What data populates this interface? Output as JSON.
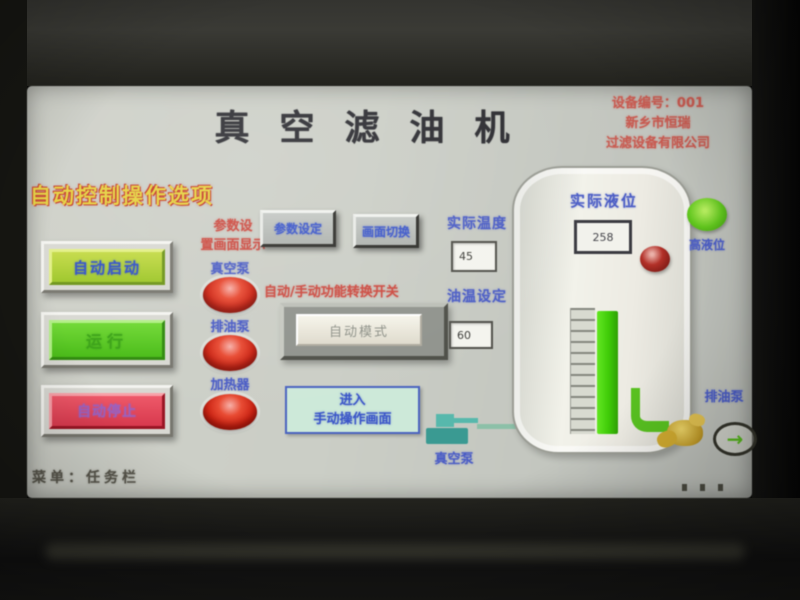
{
  "screen": {
    "title": "真空滤油机",
    "vendor": {
      "line1": "设备编号：001",
      "line2": "新乡市恒瑞",
      "line3": "过滤设备有限公司"
    },
    "left_panel": {
      "heading": "自动控制操作选项",
      "buttons": [
        {
          "label": "自动启动",
          "color": "#a8cc30"
        },
        {
          "label": "运行",
          "color": "#55c41e"
        },
        {
          "label": "自动停止",
          "color": "#e04456"
        }
      ]
    },
    "lamp_column": {
      "note_line1": "参数设",
      "note_line2": "置画面显示",
      "items": [
        {
          "label": "真空泵",
          "color": "#cc2212"
        },
        {
          "label": "排油泵",
          "color": "#cc2212"
        },
        {
          "label": "加热器",
          "color": "#cc2212"
        }
      ]
    },
    "center": {
      "param_button": "参数设定",
      "screen_button": "画面切换",
      "mode_caption": "自动/手动功能转换开关",
      "mode_button": "自动模式",
      "enter_button_line1": "进入",
      "enter_button_line2": "手动操作画面",
      "vacuum_pump_label": "真空泵"
    },
    "readouts": {
      "actual_temp_label": "实际温度",
      "actual_temp_value": "45",
      "set_temp_label": "油温设定",
      "set_temp_value": "60"
    },
    "tank": {
      "level_label": "实际液位",
      "level_value": "258"
    },
    "right": {
      "high_level_label": "高液位",
      "discharge_pump_label": "排油泵",
      "flow_arrow_icon": "→"
    },
    "footer": {
      "status": "菜单：任务栏"
    },
    "colors": {
      "accent_red": "#c8564c",
      "accent_blue": "#3b56c9",
      "accent_yellow": "#e5d13e",
      "lamp_red": "#cc2212",
      "lamp_green": "#62c81e",
      "level_bar_green": "#3fcc08",
      "screen_bg": "#c9ccc4"
    }
  }
}
